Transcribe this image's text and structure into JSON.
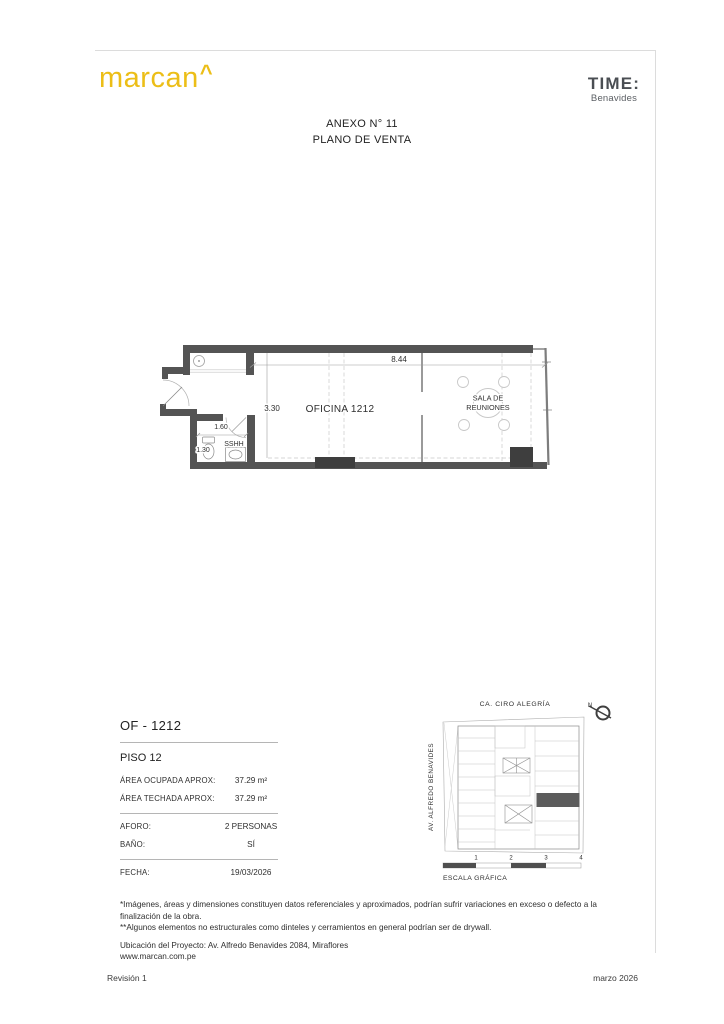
{
  "header": {
    "logo_text": "marcan",
    "logo_caret": "^",
    "brand_title": "TIME:",
    "brand_subtitle": "Benavides",
    "title_line1": "ANEXO N° 11",
    "title_line2": "PLANO DE VENTA"
  },
  "colors": {
    "brand_yellow": "#ecbe17",
    "brand_dark": "#4a4e53",
    "wall_gray": "#545454",
    "column_gray": "#3e3e3e",
    "keyplan_highlight": "#5c5c5c"
  },
  "plan": {
    "office_label": "OFICINA 1212",
    "meeting_line1": "SALA DE",
    "meeting_line2": "REUNIONES",
    "bath_label": "SSHH",
    "dim_total": "8.44",
    "dim_office": "3.30",
    "dim_bath_w": "1.60",
    "dim_bath_d": "1.30"
  },
  "info": {
    "unit": "OF - 1212",
    "floor": "PISO 12",
    "rows": [
      {
        "label": "ÁREA OCUPADA APROX:",
        "value": "37.29 m²"
      },
      {
        "label": "ÁREA TECHADA APROX:",
        "value": "37.29 m²"
      }
    ],
    "rows2": [
      {
        "label": "AFORO:",
        "value": "2 PERSONAS"
      },
      {
        "label": "BAÑO:",
        "value": "SÍ"
      }
    ],
    "date_label": "FECHA:",
    "date_value": "19/03/2026"
  },
  "map": {
    "street_top": "CA. CIRO ALEGRÍA",
    "street_left": "AV. ALFREDO BENAVIDES",
    "north_label": "N",
    "ticks": [
      "1",
      "2",
      "3",
      "4"
    ],
    "scale_label": "ESCALA GRÁFICA"
  },
  "notes": {
    "disclaimer1": "*Imágenes, áreas y dimensiones constituyen datos referenciales y aproximados, podrían sufrir variaciones en exceso o defecto a la finalización de la obra.",
    "disclaimer2": "**Algunos elementos no estructurales como dinteles y cerramientos en general podrían ser de drywall.",
    "location": "Ubicación del Proyecto: Av. Alfredo Benavides 2084, Miraflores",
    "website": "www.marcan.com.pe"
  },
  "footer": {
    "revision": "Revisión 1",
    "date": "marzo 2026"
  }
}
